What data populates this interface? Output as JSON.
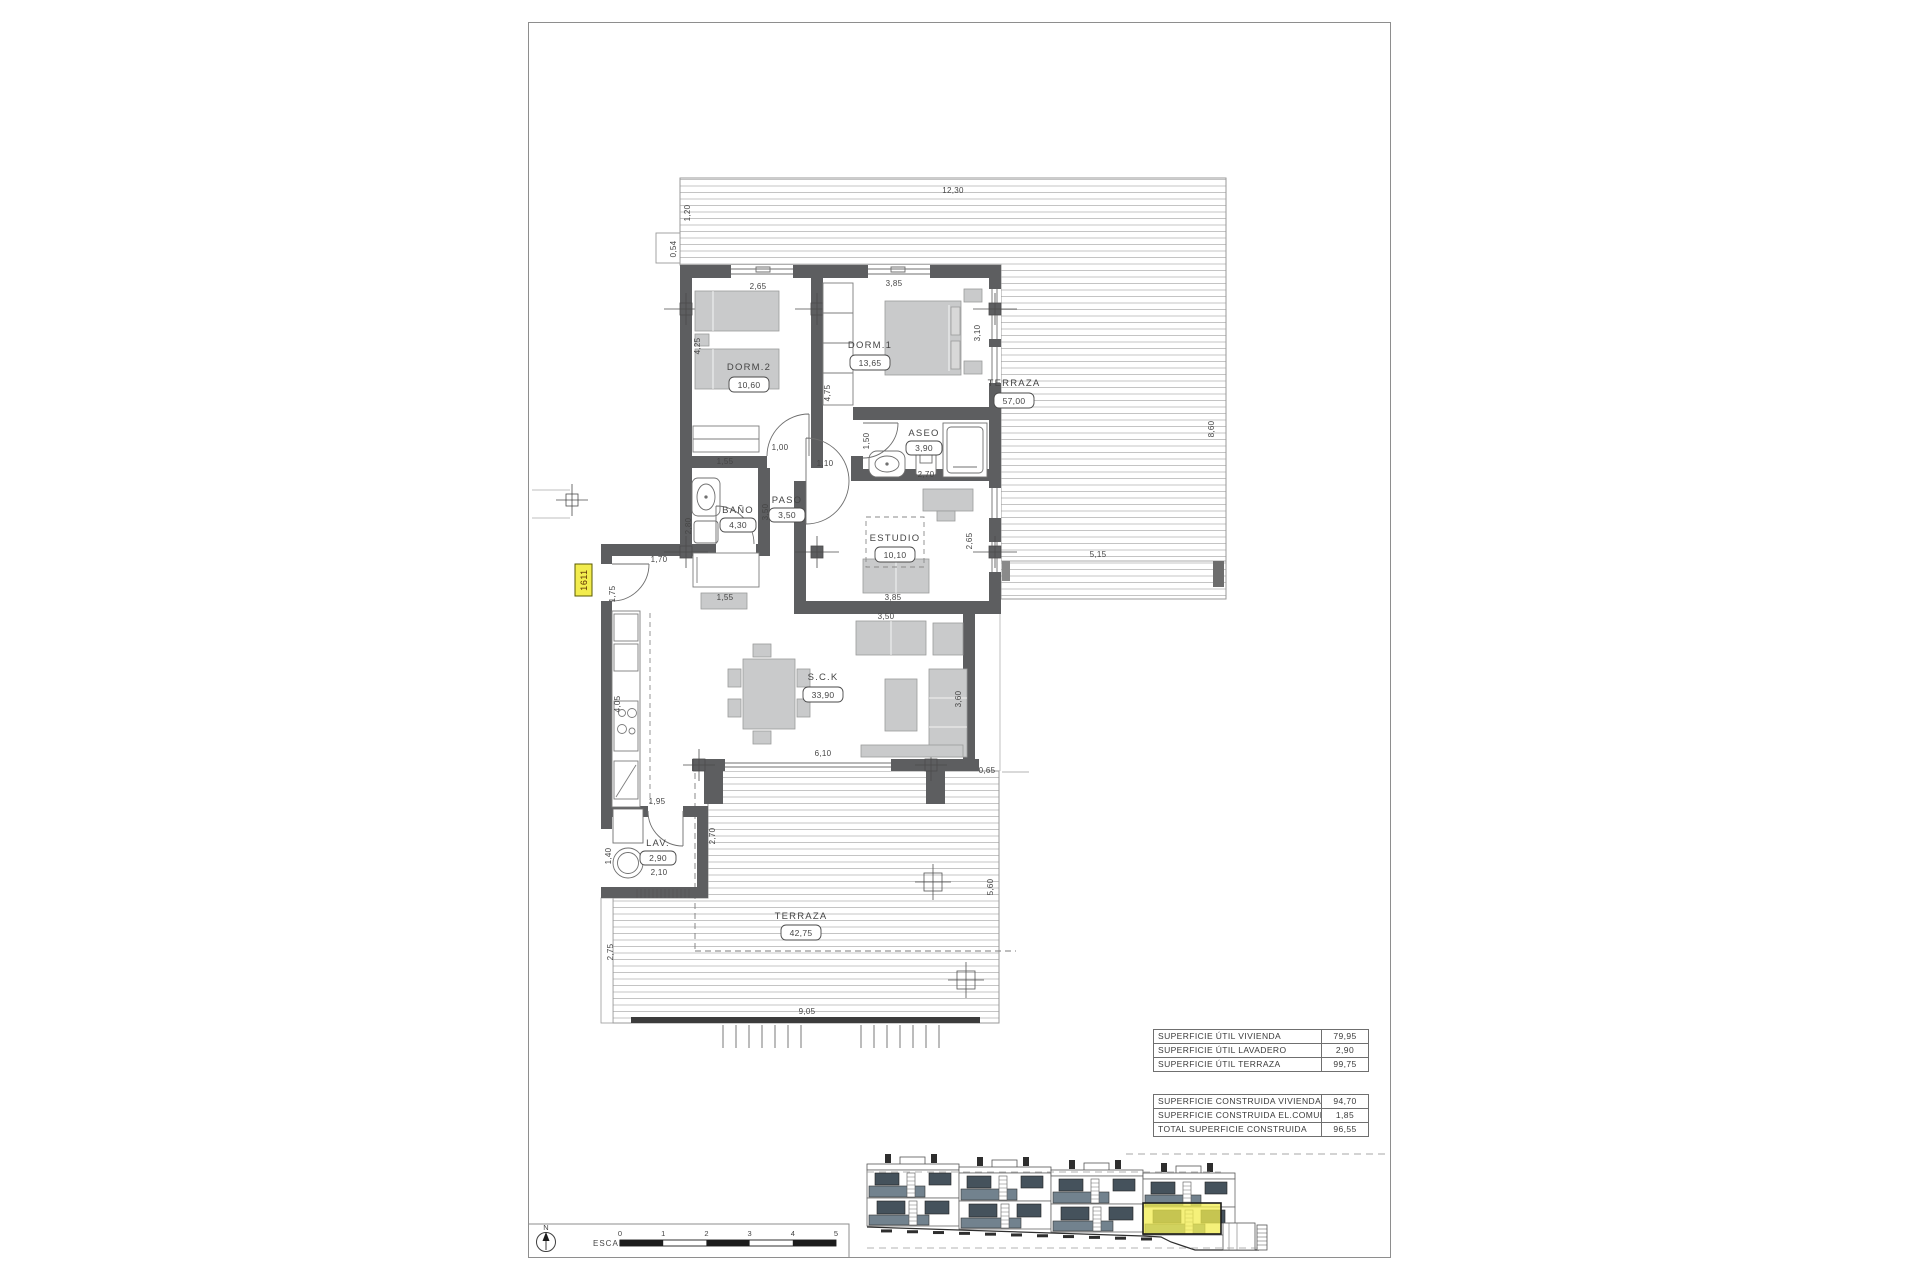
{
  "plan": {
    "unit_tag": "1611",
    "rooms": [
      {
        "id": "terraza-top",
        "label": "TERRAZA",
        "area": "57,00"
      },
      {
        "id": "dorm2",
        "label": "DORM.2",
        "area": "10,60"
      },
      {
        "id": "dorm1",
        "label": "DORM.1",
        "area": "13,65"
      },
      {
        "id": "aseo",
        "label": "ASEO",
        "area": "3,90"
      },
      {
        "id": "bano",
        "label": "BAÑO",
        "area": "4,30"
      },
      {
        "id": "paso",
        "label": "PASO",
        "area": "3,50"
      },
      {
        "id": "estudio",
        "label": "ESTUDIO",
        "area": "10,10"
      },
      {
        "id": "sck",
        "label": "S.C.K",
        "area": "33,90"
      },
      {
        "id": "lav",
        "label": "LAV.",
        "area": "2,90"
      },
      {
        "id": "terraza-bottom",
        "label": "TERRAZA",
        "area": "42,75"
      }
    ],
    "dims": [
      "12,30",
      "1,20",
      "0,54",
      "2,65",
      "3,85",
      "8,60",
      "5,15",
      "4,25",
      "4,75",
      "3,10",
      "1,55",
      "1,00",
      "1,50",
      "2,70",
      "1,10",
      "2,80",
      "3,50",
      "1,55",
      "1,70",
      "1,75",
      "3,85",
      "2,65",
      "3,50",
      "3,60",
      "6,10",
      "0,65",
      "4,05",
      "1,95",
      "2,70",
      "1,40",
      "2,10",
      "2,75",
      "5,60",
      "9,05"
    ]
  },
  "tables": {
    "util": {
      "rows": [
        {
          "label": "SUPERFICIE ÚTIL VIVIENDA",
          "value": "79,95"
        },
        {
          "label": "SUPERFICIE ÚTIL LAVADERO",
          "value": "2,90"
        },
        {
          "label": "SUPERFICIE ÚTIL TERRAZA",
          "value": "99,75"
        }
      ]
    },
    "construida": {
      "rows": [
        {
          "label": "SUPERFICIE CONSTRUIDA VIVIENDA",
          "value": "94,70"
        },
        {
          "label": "SUPERFICIE CONSTRUIDA EL.COMUNES",
          "value": "1,85"
        },
        {
          "label": "TOTAL SUPERFICIE CONSTRUIDA",
          "value": "96,55"
        }
      ]
    }
  },
  "scalebar": {
    "label": "ESCALA :",
    "north": "N",
    "ticks": [
      "0",
      "1",
      "2",
      "3",
      "4",
      "5"
    ]
  },
  "colors": {
    "wall": "#5d5e60",
    "deck_line": "#b6b6b6",
    "furniture": "#c9cacb",
    "highlight": "#f2ec4e",
    "railing": "#72828e",
    "ink": "#454545"
  }
}
